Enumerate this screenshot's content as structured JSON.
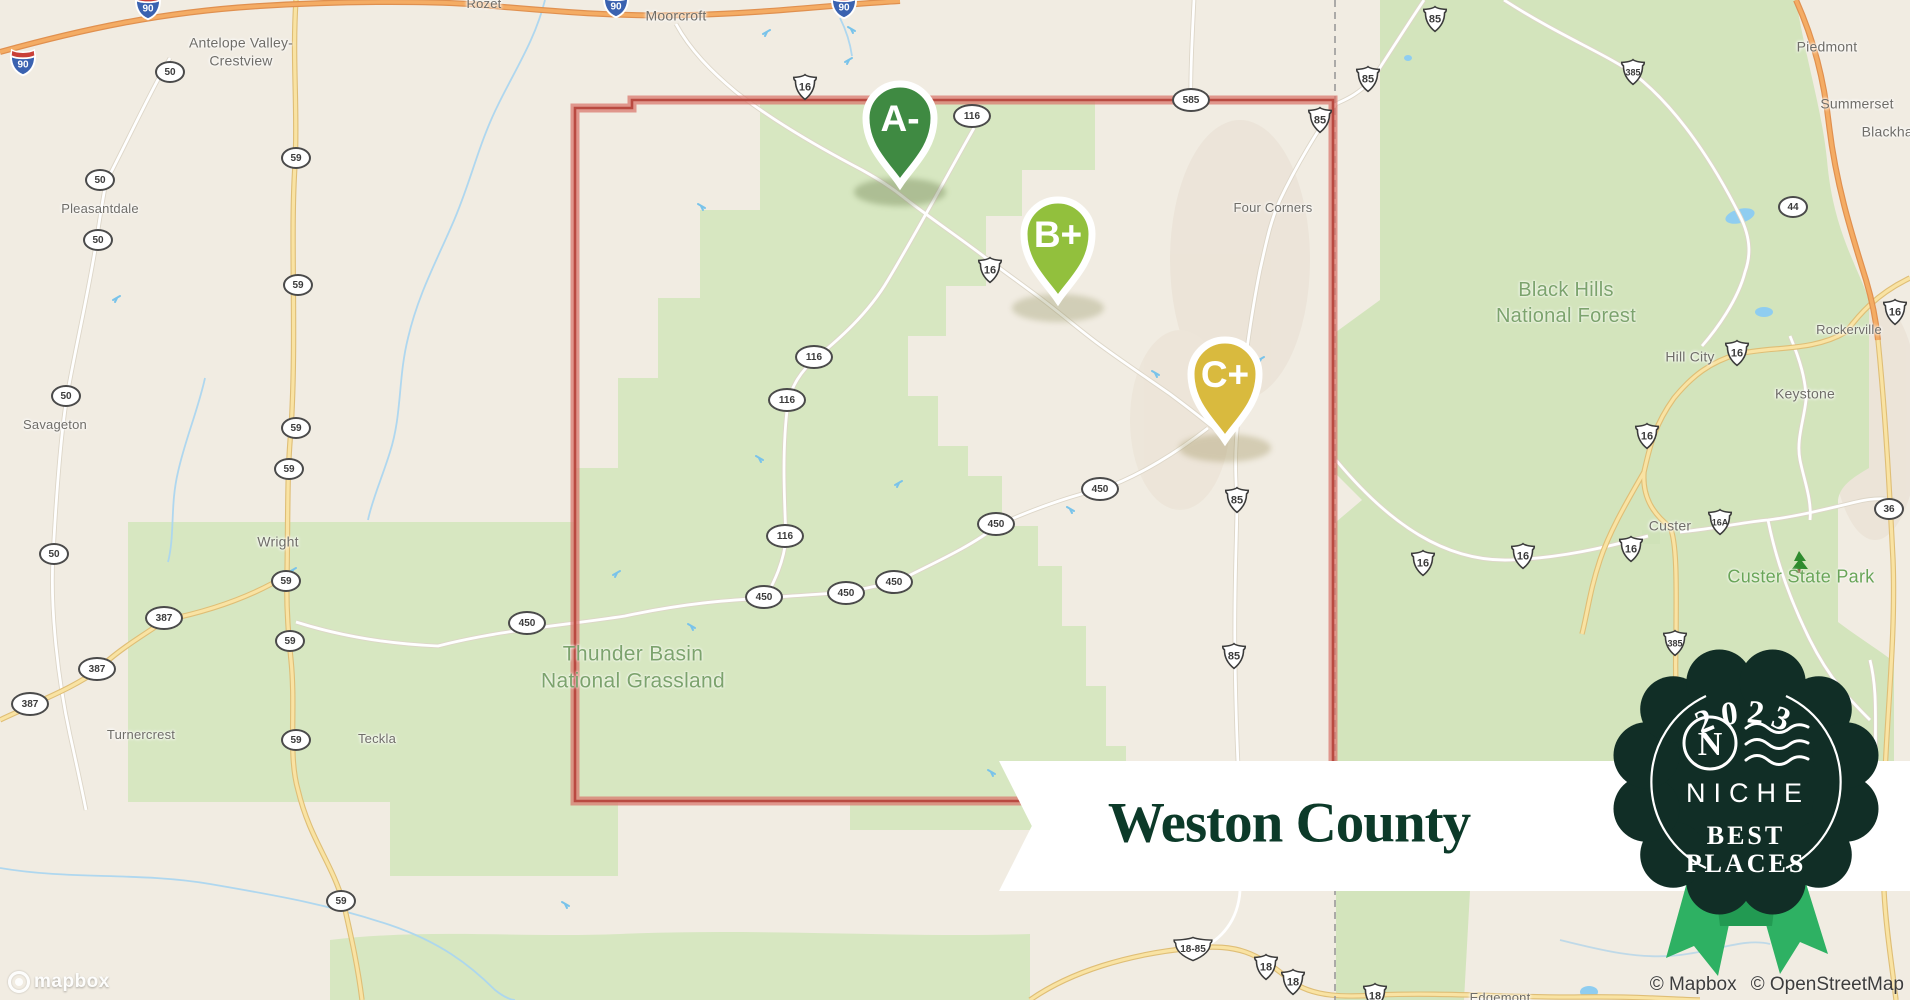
{
  "map": {
    "colors": {
      "beige": "#f1ece2",
      "green_area": "#d7e7c1",
      "forest_green": "#d3e4bc",
      "water": "#8fcdf0",
      "river": "#abd6ef",
      "road_white": "#ffffff",
      "road_yellow": "#f9e3a3",
      "road_yellow_casing": "#dfbe76",
      "road_orange": "#f4ac64",
      "road_orange_casing": "#e0904f",
      "county_red": "#c65349",
      "county_red_halo": "#d97a6f",
      "state_line_gray": "#9a9a9a",
      "label_gray": "#6f6d68",
      "area_label_green": "#7ca36d",
      "park_label_green": "#69a558",
      "banner_bg": "#ffffff",
      "banner_text": "#0c3a29",
      "badge_bg": "#112e26",
      "ribbon_green": "#2eb163"
    },
    "pins": [
      {
        "grade": "A-",
        "color": "#3f8a42",
        "tip_x": 900,
        "tip_y": 188
      },
      {
        "grade": "B+",
        "color": "#92c03d",
        "tip_x": 1058,
        "tip_y": 304
      },
      {
        "grade": "C+",
        "color": "#d9ba3e",
        "tip_x": 1225,
        "tip_y": 444
      }
    ],
    "towns": [
      {
        "name": "Rozet",
        "x": 484,
        "y": 4,
        "size": "small"
      },
      {
        "name": "Moorcroft",
        "x": 676,
        "y": 16,
        "size": "normal"
      },
      {
        "name": "Antelope Valley-\nCrestview",
        "x": 241,
        "y": 52,
        "size": "normal"
      },
      {
        "name": "Pleasantdale",
        "x": 100,
        "y": 209,
        "size": "small"
      },
      {
        "name": "Savageton",
        "x": 55,
        "y": 425,
        "size": "small"
      },
      {
        "name": "Wright",
        "x": 278,
        "y": 542,
        "size": "normal"
      },
      {
        "name": "Turnercrest",
        "x": 141,
        "y": 735,
        "size": "small"
      },
      {
        "name": "Teckla",
        "x": 377,
        "y": 739,
        "size": "small"
      },
      {
        "name": "Four Corners",
        "x": 1273,
        "y": 208,
        "size": "small"
      },
      {
        "name": "Piedmont",
        "x": 1827,
        "y": 47,
        "size": "normal"
      },
      {
        "name": "Summerset",
        "x": 1857,
        "y": 104,
        "size": "normal"
      },
      {
        "name": "Blackhawk",
        "x": 1896,
        "y": 132,
        "size": "normal"
      },
      {
        "name": "Rockerville",
        "x": 1849,
        "y": 330,
        "size": "small"
      },
      {
        "name": "Hill City",
        "x": 1690,
        "y": 357,
        "size": "normal"
      },
      {
        "name": "Keystone",
        "x": 1805,
        "y": 394,
        "size": "normal"
      },
      {
        "name": "Custer",
        "x": 1670,
        "y": 526,
        "size": "normal"
      },
      {
        "name": "Edgemont",
        "x": 1500,
        "y": 998,
        "size": "small"
      }
    ],
    "area_labels": [
      {
        "text": "Thunder Basin\nNational Grassland",
        "x": 633,
        "y": 668,
        "color": "#7ca36d",
        "size": 21
      },
      {
        "text": "Black Hills\nNational Forest",
        "x": 1566,
        "y": 303,
        "color": "#7ca36d",
        "size": 20
      },
      {
        "text": "Custer State Park",
        "x": 1801,
        "y": 577,
        "color": "#69a558",
        "size": 18,
        "icon": "tree-icon"
      }
    ],
    "shields": [
      {
        "type": "interstate",
        "text": "90",
        "x": 23,
        "y": 62
      },
      {
        "type": "interstate",
        "text": "90",
        "x": 148,
        "y": 6
      },
      {
        "type": "interstate",
        "text": "90",
        "x": 616,
        "y": 4
      },
      {
        "type": "interstate",
        "text": "90",
        "x": 844,
        "y": 5
      },
      {
        "type": "oval",
        "text": "50",
        "x": 170,
        "y": 72
      },
      {
        "type": "oval",
        "text": "50",
        "x": 100,
        "y": 180
      },
      {
        "type": "oval",
        "text": "50",
        "x": 98,
        "y": 240
      },
      {
        "type": "oval",
        "text": "50",
        "x": 66,
        "y": 396
      },
      {
        "type": "oval",
        "text": "50",
        "x": 54,
        "y": 554
      },
      {
        "type": "oval",
        "text": "59",
        "x": 296,
        "y": 158
      },
      {
        "type": "oval",
        "text": "59",
        "x": 298,
        "y": 285
      },
      {
        "type": "oval",
        "text": "59",
        "x": 296,
        "y": 428
      },
      {
        "type": "oval",
        "text": "59",
        "x": 289,
        "y": 469
      },
      {
        "type": "oval",
        "text": "59",
        "x": 286,
        "y": 581
      },
      {
        "type": "oval",
        "text": "59",
        "x": 290,
        "y": 641
      },
      {
        "type": "oval",
        "text": "59",
        "x": 296,
        "y": 740
      },
      {
        "type": "oval",
        "text": "59",
        "x": 341,
        "y": 901
      },
      {
        "type": "oval",
        "text": "387",
        "x": 164,
        "y": 618
      },
      {
        "type": "oval",
        "text": "387",
        "x": 97,
        "y": 669
      },
      {
        "type": "oval",
        "text": "387",
        "x": 30,
        "y": 704
      },
      {
        "type": "oval",
        "text": "450",
        "x": 527,
        "y": 623
      },
      {
        "type": "oval",
        "text": "450",
        "x": 764,
        "y": 597
      },
      {
        "type": "oval",
        "text": "450",
        "x": 846,
        "y": 593
      },
      {
        "type": "oval",
        "text": "450",
        "x": 894,
        "y": 582
      },
      {
        "type": "oval",
        "text": "450",
        "x": 996,
        "y": 524
      },
      {
        "type": "oval",
        "text": "450",
        "x": 1100,
        "y": 489
      },
      {
        "type": "oval",
        "text": "116",
        "x": 972,
        "y": 116
      },
      {
        "type": "oval",
        "text": "116",
        "x": 814,
        "y": 357
      },
      {
        "type": "oval",
        "text": "116",
        "x": 787,
        "y": 400
      },
      {
        "type": "oval",
        "text": "116",
        "x": 785,
        "y": 536
      },
      {
        "type": "oval",
        "text": "585",
        "x": 1191,
        "y": 100
      },
      {
        "type": "oval",
        "text": "44",
        "x": 1793,
        "y": 207
      },
      {
        "type": "oval",
        "text": "36",
        "x": 1889,
        "y": 509
      },
      {
        "type": "us",
        "text": "16",
        "x": 805,
        "y": 87
      },
      {
        "type": "us",
        "text": "16",
        "x": 990,
        "y": 270
      },
      {
        "type": "us",
        "text": "16",
        "x": 1423,
        "y": 563
      },
      {
        "type": "us",
        "text": "16",
        "x": 1523,
        "y": 556
      },
      {
        "type": "us",
        "text": "16",
        "x": 1631,
        "y": 549
      },
      {
        "type": "us",
        "text": "16",
        "x": 1647,
        "y": 436
      },
      {
        "type": "us",
        "text": "16",
        "x": 1737,
        "y": 353
      },
      {
        "type": "us",
        "text": "16",
        "x": 1895,
        "y": 312
      },
      {
        "type": "us",
        "text": "16A",
        "x": 1720,
        "y": 522
      },
      {
        "type": "us",
        "text": "85",
        "x": 1435,
        "y": 19
      },
      {
        "type": "us",
        "text": "85",
        "x": 1368,
        "y": 79
      },
      {
        "type": "us",
        "text": "85",
        "x": 1320,
        "y": 120
      },
      {
        "type": "us",
        "text": "85",
        "x": 1237,
        "y": 500
      },
      {
        "type": "us",
        "text": "85",
        "x": 1234,
        "y": 656
      },
      {
        "type": "us",
        "text": "385",
        "x": 1633,
        "y": 72
      },
      {
        "type": "us",
        "text": "385",
        "x": 1675,
        "y": 643
      },
      {
        "type": "uswide",
        "text": "18-85",
        "x": 1193,
        "y": 949
      },
      {
        "type": "us",
        "text": "18",
        "x": 1266,
        "y": 967
      },
      {
        "type": "us",
        "text": "18",
        "x": 1293,
        "y": 982
      },
      {
        "type": "us",
        "text": "18",
        "x": 1375,
        "y": 996
      }
    ],
    "banner": {
      "title": "Weston County"
    },
    "badge": {
      "year": "2023",
      "brand": "NICHE",
      "tagline_line1": "BEST",
      "tagline_line2": "PLACES",
      "logo_letter": "N"
    },
    "attribution": {
      "mapbox": "© Mapbox",
      "osm": "© OpenStreetMap"
    },
    "logo_word": "mapbox"
  }
}
